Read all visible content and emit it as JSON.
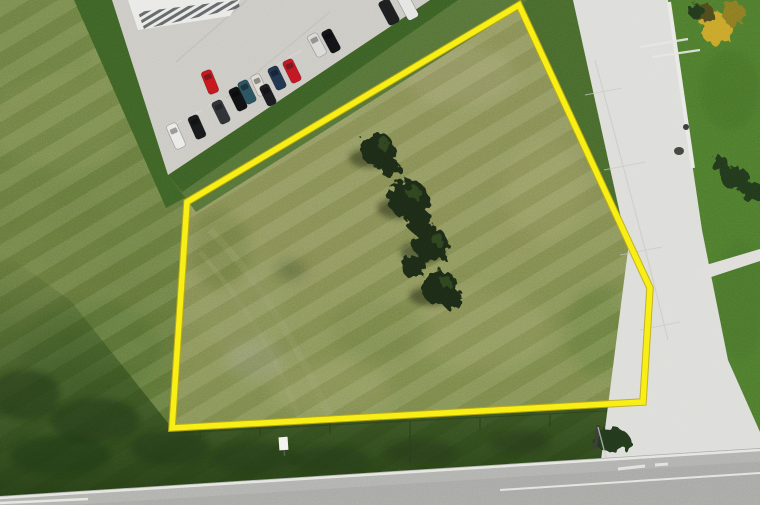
{
  "scene": {
    "kind": "aerial-drone-photo",
    "subject": "vacant land parcel outlined with yellow property boundary",
    "width": 760,
    "height": 505
  },
  "boundary": {
    "points": "519,5 650,288 643,402 172,428 187,202",
    "color": "#f8ee15",
    "under_color": "#b9a60e",
    "stroke_width": 5.5
  },
  "parcel": {
    "fill": "#8d9258"
  },
  "terrain": {
    "grass_outer": "#687b3d",
    "grass_dark_band": "#3d6126",
    "strip_right": "#47682c",
    "verge_dark": "#223d14",
    "lawn_right": "#4d7a2d"
  },
  "parking": {
    "lot_fill": "#cbc9c3",
    "lot_points": "112,0 430,0 168,175",
    "cars": [
      {
        "color": "#e9e9e7"
      },
      {
        "color": "#17181a"
      },
      {
        "color": "#2e3134"
      },
      {
        "color": "#101113"
      },
      {
        "color": "#c4161d"
      },
      {
        "color": "#29515c"
      },
      {
        "color": "#dedad2"
      },
      {
        "color": "#1a1b1e"
      },
      {
        "color": "#20344d"
      },
      {
        "color": "#c01722"
      },
      {
        "color": "#d8d8d6"
      },
      {
        "color": "#121316"
      },
      {
        "color": "#1c1d1f"
      },
      {
        "color": "#e4e4e2"
      }
    ]
  },
  "building": {
    "roof_fill": "#e9e9e6",
    "rib_fill": "#51555a",
    "points": "128,0 240,0 230,16 138,30"
  },
  "roads": {
    "concrete": {
      "fill": "#dcdcd9",
      "points": "573,0 668,0 702,230 728,360 760,432 760,472 600,468 628,250"
    },
    "asphalt": {
      "fill": "#a7a7a4",
      "points": "0,496 760,448 760,505 0,505",
      "edge_line_color": "#eaeae7"
    },
    "sidewalk_spur_points": "696,268 760,249 760,261 699,281",
    "curb_color": "#e8e8e5"
  },
  "vegetation": {
    "tree_fill": "#1c2912",
    "tree_highlight": "#3f5c28",
    "tree_count": 5,
    "autumn_tree_fill": "#c7a42c",
    "shrub_fill": "#24391a"
  },
  "markers": {
    "sign_fill": "#f2f2ef",
    "pole_color": "#3a3a38",
    "wire_color": "#e5e5e2"
  }
}
